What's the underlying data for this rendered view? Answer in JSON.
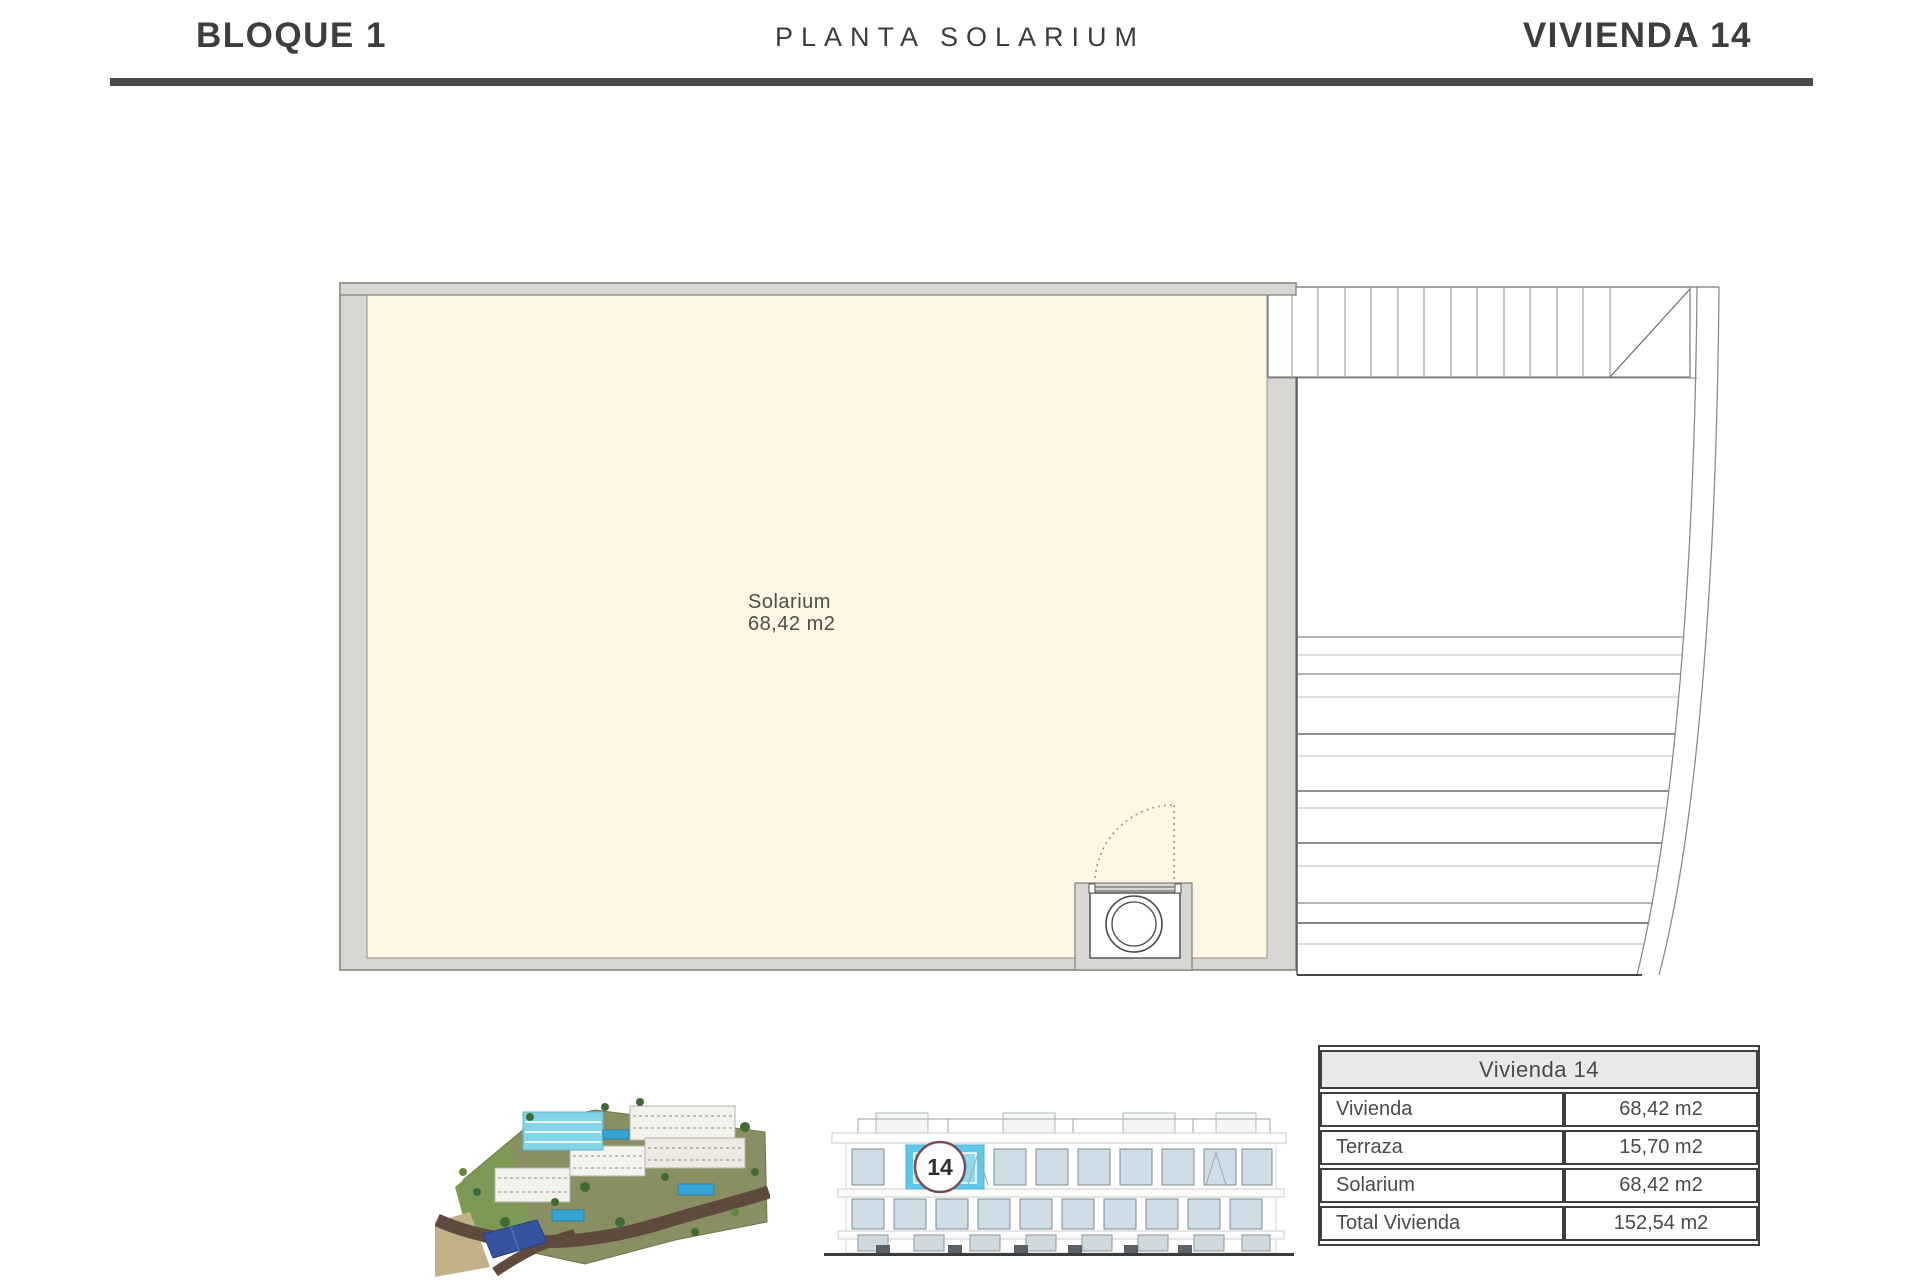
{
  "header": {
    "block_title": "BLOQUE 1",
    "plan_title": "PLANTA SOLARIUM",
    "unit_title": "VIVIENDA 14"
  },
  "floor_plan": {
    "room_name": "Solarium",
    "room_area": "68,42 m2"
  },
  "elevation": {
    "unit_number": "14"
  },
  "summary_table": {
    "title": "Vivienda 14",
    "rows": [
      {
        "label": "Vivienda",
        "value": "68,42 m2"
      },
      {
        "label": "Terraza",
        "value": "15,70 m2"
      },
      {
        "label": "Solarium",
        "value": "68,42 m2"
      },
      {
        "label": "Total Vivienda",
        "value": "152,54 m2"
      }
    ]
  },
  "colors": {
    "divider": "#4a4a4a",
    "room_fill_cream": "#fdf6e5",
    "wall_gray": "#d8d7d3",
    "highlight_blue": "#5ec9e9",
    "unit_badge_ring": "#7c4a54",
    "door_swing_dotted": "#9c9a6c",
    "table_header_bg": "#e9e9e9"
  }
}
